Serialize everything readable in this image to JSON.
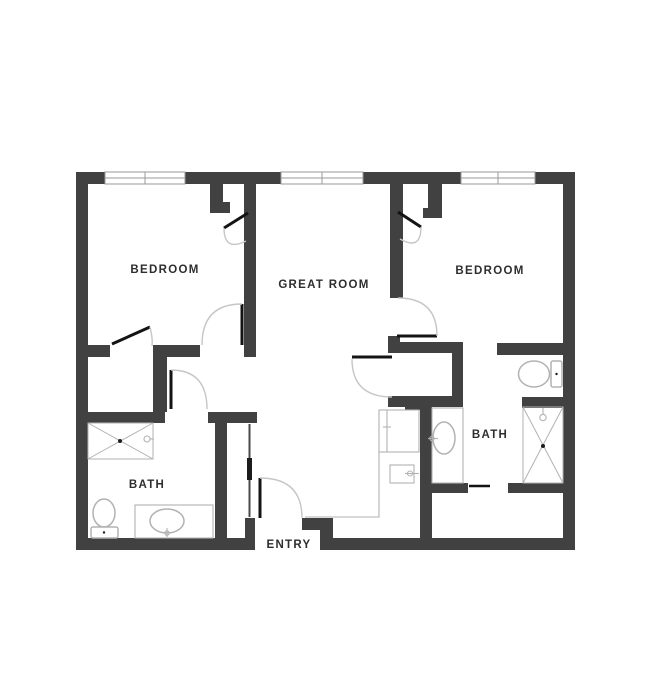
{
  "floorplan": {
    "description": "Two bedroom, two bath apartment floor plan with great room and entry",
    "colors": {
      "wall": "#414141",
      "door": "#141414",
      "swing_arc": "#c6c6c6",
      "fixture": "#b2b2b2",
      "window_line": "#9a9a9a",
      "label": "#2e2e2e",
      "background": "#ffffff"
    },
    "rooms": [
      {
        "name": "bedroom-left",
        "label": "BEDROOM"
      },
      {
        "name": "great-room",
        "label": "GREAT ROOM"
      },
      {
        "name": "bedroom-right",
        "label": "BEDROOM"
      },
      {
        "name": "bath-left",
        "label": "BATH"
      },
      {
        "name": "bath-right",
        "label": "BATH"
      },
      {
        "name": "entry",
        "label": "ENTRY"
      }
    ],
    "windows_count": 3,
    "fixture_icons": [
      "toilet-icon",
      "shower-icon",
      "sink-icon",
      "vanity-icon",
      "refrigerator-icon",
      "counter-icon",
      "shower-head-icon",
      "faucet-icon"
    ]
  }
}
